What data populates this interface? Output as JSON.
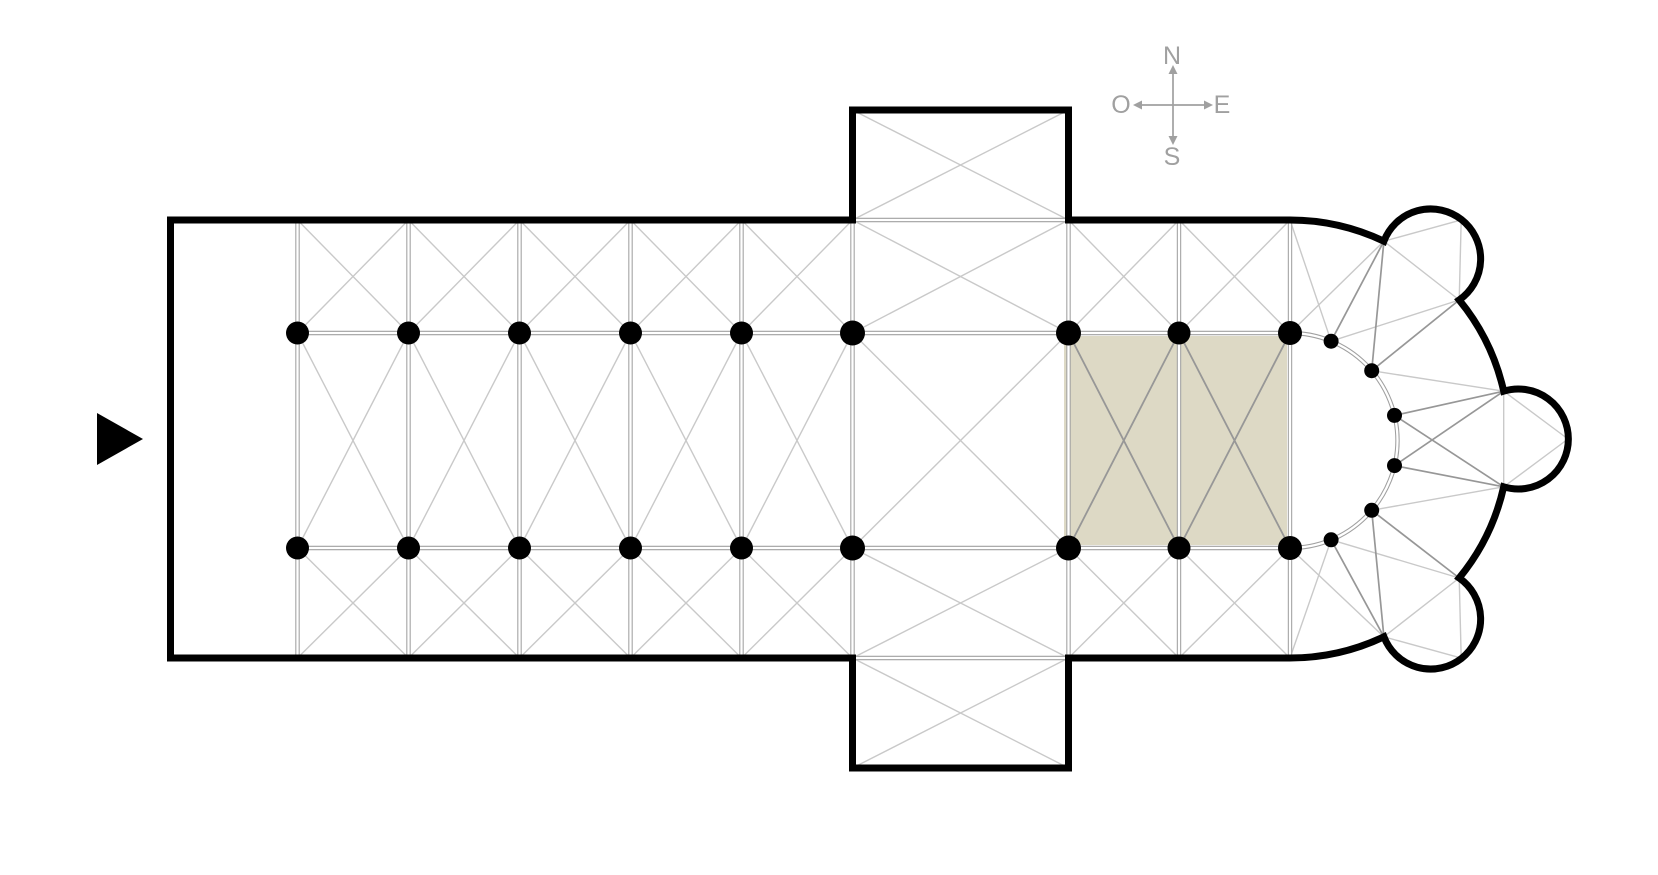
{
  "page": {
    "title": "Church floor plan diagram",
    "background": "#ffffff"
  },
  "compass": {
    "north_label": "N",
    "east_label": "E",
    "south_label": "S",
    "west_label": "O"
  },
  "colors": {
    "wall": "#000000",
    "structure_line": "#a0a0a0",
    "rib_line": "#c9c9c9",
    "rib_line_dark": "#979797",
    "highlight_fill": "#ddd9c5",
    "compass": "#a0a0a0",
    "background": "#ffffff",
    "marker": "#000000"
  },
  "plan": {
    "highlighted_bay_count": 2,
    "radiating_chapel_count": 3,
    "nave_bay_count_west_of_crossing": 5,
    "choir_bay_count_east_of_crossing": 2,
    "main_column_dot_count": 18,
    "hemicycle_column_dot_count": 6,
    "transept_arm_count": 2,
    "entrance_side": "west"
  }
}
